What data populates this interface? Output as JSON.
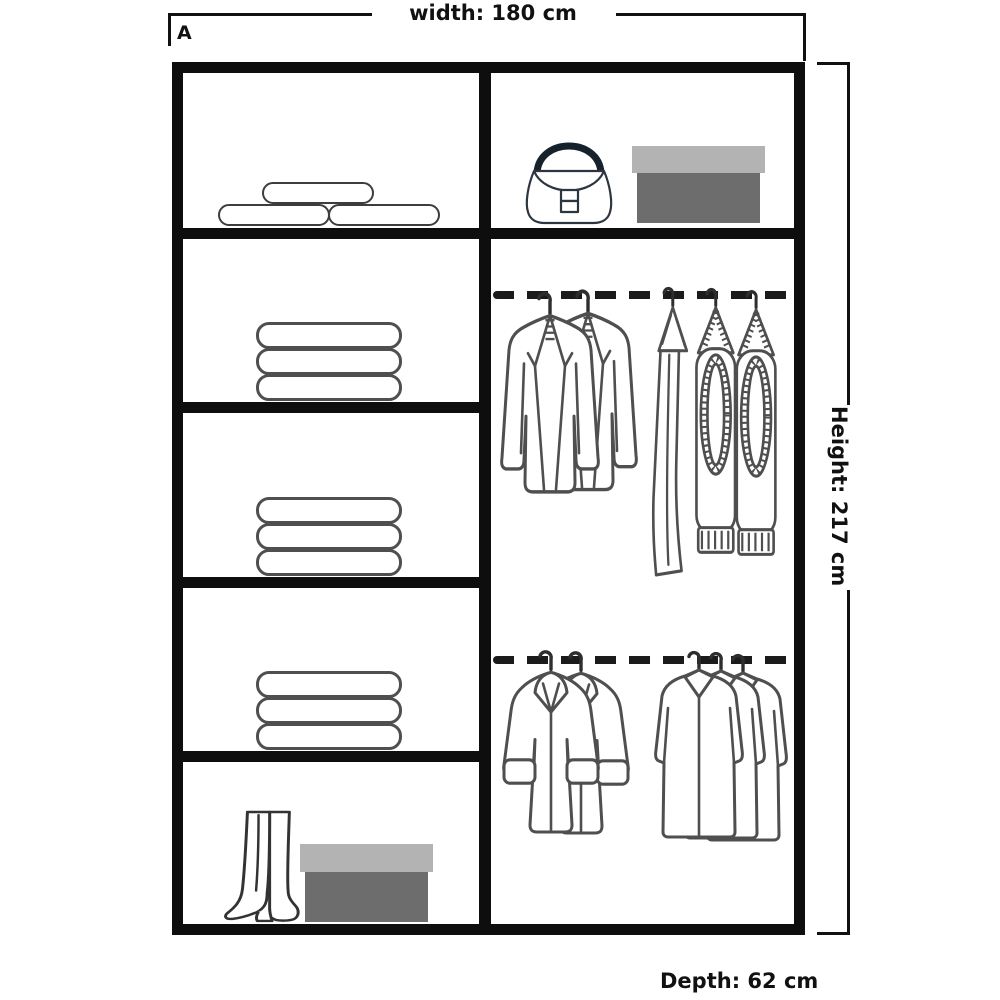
{
  "labels": {
    "section_letter": "A",
    "width": "width: 180 cm",
    "height": "Height: 217 cm",
    "depth": "Depth: 62 cm"
  },
  "wardrobe": {
    "left_column": {
      "shelf_count": 5,
      "shelves": [
        {
          "id": "shelf-1",
          "contents": "rolled-pillows",
          "item_count": 3
        },
        {
          "id": "shelf-2",
          "contents": "folded-towel-stack",
          "item_count": 3
        },
        {
          "id": "shelf-3",
          "contents": "folded-towel-stack",
          "item_count": 3
        },
        {
          "id": "shelf-4",
          "contents": "folded-towel-stack",
          "item_count": 3
        },
        {
          "id": "shelf-5",
          "contents": "boots-and-shoebox",
          "item_count": 2
        }
      ]
    },
    "right_column": {
      "top_shelf": {
        "contents": "handbag-and-shoebox",
        "item_count": 2
      },
      "upper_rail": {
        "type": "hanging-rail",
        "jackets": 2,
        "trousers": 3
      },
      "lower_rail": {
        "type": "hanging-rail",
        "coats": 2,
        "shirts": 3
      }
    }
  },
  "icons": {
    "pillow-roll-icon": "rounded-capsule-outline",
    "towel-stack-icon": "three-stacked-capsules",
    "boots-icon": "pair-of-heeled-boots",
    "shoebox-icon": "two-tone-gray-box",
    "handbag-icon": "flap-handbag-with-dark-handle",
    "jacket-pair-icon": "two-blazers-on-hangers",
    "trouser-group-icon": "three-hanging-trousers",
    "coat-pair-icon": "two-cuffed-coats-on-hangers",
    "shirt-group-icon": "three-collared-shirts-on-hangers",
    "hanging-rail-icon": "thick-dashed-line"
  },
  "colors": {
    "frame": "#0e0e0e",
    "garment_outline": "#4f4f4f",
    "accessory_outline": "#333333",
    "handbag_handle": "#15212b",
    "shoebox_lid": "#b3b3b3",
    "shoebox_base": "#6d6d6d",
    "rail_dash": "#1b1b1b",
    "dimension_line": "#111111"
  }
}
